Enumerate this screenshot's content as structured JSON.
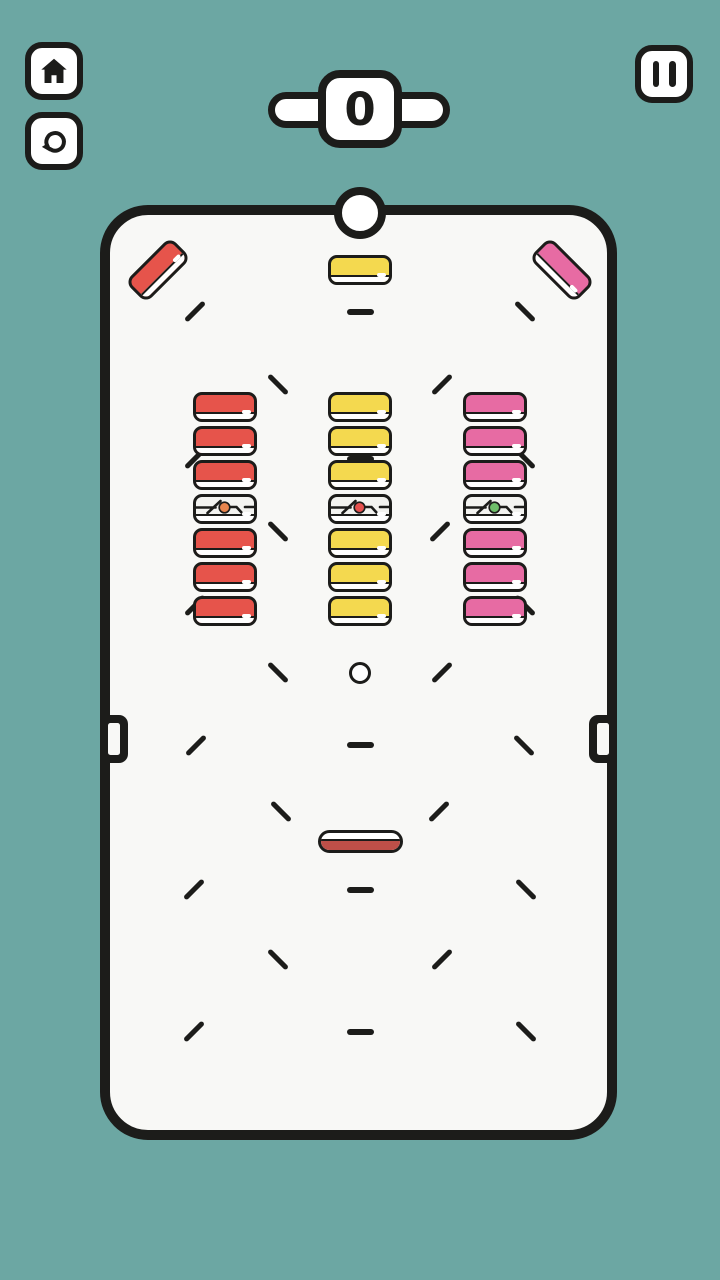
{
  "colors": {
    "background": "#6CA7A3",
    "board_fill": "#F8F8F6",
    "white": "#FFFFFF",
    "outline": "#1C1C1A",
    "red": "#E6544B",
    "yellow": "#F4D94F",
    "pink": "#E76BA3",
    "special_fill": "#F3F3F0",
    "dot_orange": "#E8854E",
    "dot_red": "#E5504E",
    "dot_green": "#6EBE69",
    "paddle_red": "#BE4F48"
  },
  "hud": {
    "score_value": "0",
    "home_button": {
      "icon": "home-icon"
    },
    "restart_button": {
      "icon": "restart-icon"
    },
    "pause_button": {
      "icon": "pause-icon"
    }
  },
  "game": {
    "top_ball": {
      "x": 360,
      "y": 213,
      "r": 26
    },
    "mini_ball": {
      "x": 360,
      "y": 673,
      "r": 11
    },
    "corner_bricks": [
      {
        "color": "red",
        "x": 158,
        "y": 270,
        "rot": -45
      },
      {
        "color": "yellow",
        "x": 360,
        "y": 270,
        "rot": 0
      },
      {
        "color": "pink",
        "x": 562,
        "y": 270,
        "rot": 45
      }
    ],
    "brick_columns": [
      {
        "cx": 225,
        "color": "red",
        "special_dot": "dot_orange"
      },
      {
        "cx": 360,
        "color": "yellow",
        "special_dot": "dot_red"
      },
      {
        "cx": 495,
        "color": "pink",
        "special_dot": "dot_green"
      }
    ],
    "brick_grid": {
      "top": 392,
      "brick_w": 64,
      "brick_h": 30,
      "gap": 4,
      "rows": 7,
      "special_row": 3
    },
    "paddle": {
      "x": 360,
      "y": 841,
      "w": 85,
      "h": 23
    },
    "wall_slots": [
      {
        "side": "left",
        "x": 100,
        "y": 715
      },
      {
        "side": "right",
        "x": 589,
        "y": 715
      }
    ],
    "dashes": [
      {
        "x": 195,
        "y": 312,
        "t": "slash"
      },
      {
        "x": 360,
        "y": 312,
        "t": "h"
      },
      {
        "x": 525,
        "y": 312,
        "t": "backslash"
      },
      {
        "x": 278,
        "y": 385,
        "t": "backslash"
      },
      {
        "x": 442,
        "y": 385,
        "t": "slash"
      },
      {
        "x": 195,
        "y": 459,
        "t": "slash"
      },
      {
        "x": 360,
        "y": 459,
        "t": "h"
      },
      {
        "x": 525,
        "y": 459,
        "t": "backslash"
      },
      {
        "x": 278,
        "y": 532,
        "t": "backslash"
      },
      {
        "x": 440,
        "y": 532,
        "t": "slash"
      },
      {
        "x": 195,
        "y": 606,
        "t": "slash"
      },
      {
        "x": 360,
        "y": 606,
        "t": "h"
      },
      {
        "x": 525,
        "y": 606,
        "t": "backslash"
      },
      {
        "x": 278,
        "y": 673,
        "t": "backslash"
      },
      {
        "x": 442,
        "y": 673,
        "t": "slash"
      },
      {
        "x": 196,
        "y": 746,
        "t": "slash"
      },
      {
        "x": 360,
        "y": 745,
        "t": "h"
      },
      {
        "x": 524,
        "y": 746,
        "t": "backslash"
      },
      {
        "x": 281,
        "y": 812,
        "t": "backslash"
      },
      {
        "x": 439,
        "y": 812,
        "t": "slash"
      },
      {
        "x": 194,
        "y": 890,
        "t": "slash"
      },
      {
        "x": 360,
        "y": 890,
        "t": "h"
      },
      {
        "x": 526,
        "y": 890,
        "t": "backslash"
      },
      {
        "x": 278,
        "y": 960,
        "t": "backslash"
      },
      {
        "x": 442,
        "y": 960,
        "t": "slash"
      },
      {
        "x": 194,
        "y": 1032,
        "t": "slash"
      },
      {
        "x": 360,
        "y": 1032,
        "t": "h"
      },
      {
        "x": 526,
        "y": 1032,
        "t": "backslash"
      }
    ]
  }
}
